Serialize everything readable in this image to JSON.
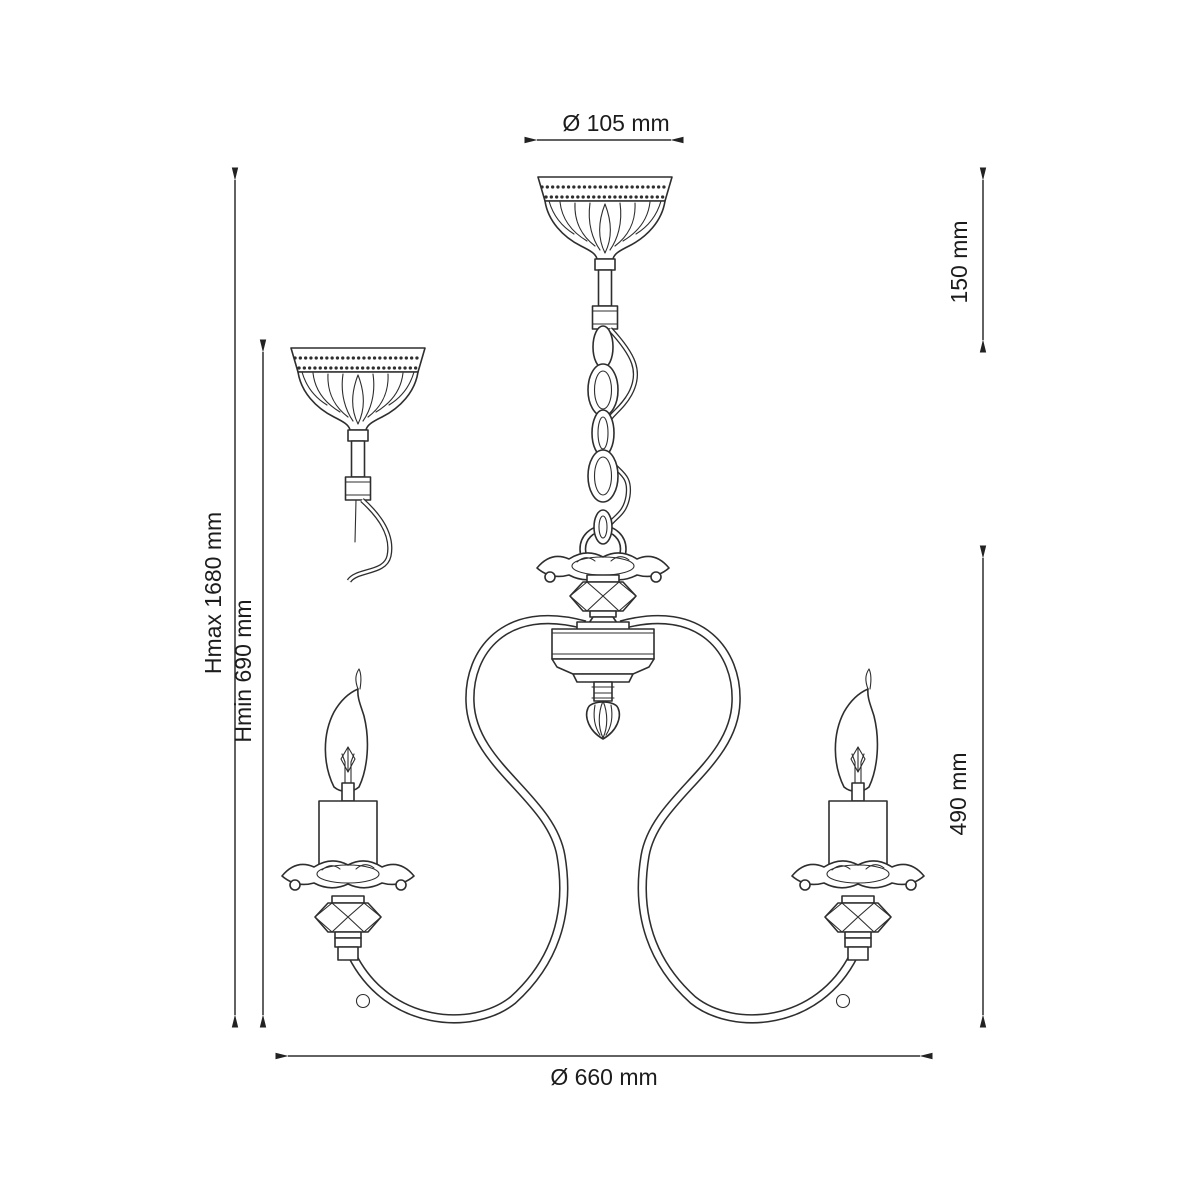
{
  "diagram": {
    "type": "chandelier-dimension-drawing",
    "dims": {
      "canopy_diameter": "Ø 105 mm",
      "suspension_top_height": "150 mm",
      "height_max": "Hmax 1680 mm",
      "height_min": "Hmin 690 mm",
      "body_height": "490 mm",
      "body_diameter": "Ø 660 mm"
    },
    "colors": {
      "line": "#2e2e2e",
      "text": "#1c1c1c",
      "background": "#ffffff"
    }
  }
}
